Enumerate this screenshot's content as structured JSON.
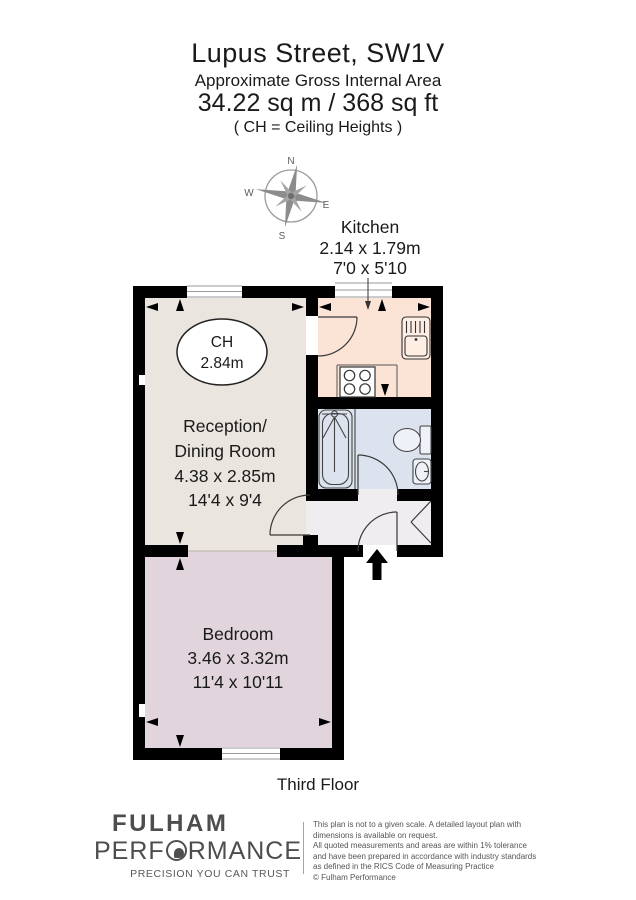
{
  "header": {
    "title": "Lupus Street, SW1V",
    "subtitle": "Approximate Gross Internal Area",
    "area": "34.22 sq m / 368 sq ft",
    "ch_note": "( CH = Ceiling Heights )"
  },
  "compass": {
    "n": "N",
    "e": "E",
    "s": "S",
    "w": "W"
  },
  "rooms": {
    "kitchen": {
      "name": "Kitchen",
      "dims_m": "2.14 x 1.79m",
      "dims_ft": "7'0 x 5'10"
    },
    "reception": {
      "name_line1": "Reception/",
      "name_line2": "Dining Room",
      "dims_m": "4.38 x 2.85m",
      "dims_ft": "14'4 x 9'4"
    },
    "bedroom": {
      "name": "Bedroom",
      "dims_m": "3.46 x 3.32m",
      "dims_ft": "11'4 x 10'11"
    },
    "ceiling_height": {
      "label": "CH",
      "value": "2.84m"
    }
  },
  "floor_label": "Third Floor",
  "footer": {
    "brand_line1": "FULHAM",
    "brand_line2_pre": "PERF",
    "brand_line2_post": "RMANCE",
    "tagline": "PRECISION YOU CAN TRUST",
    "disclaimer": [
      "This plan is not to a given scale. A detailed layout plan with",
      "dimensions is available on request.",
      "All quoted measurements and areas are within 1% tolerance",
      "and have been prepared in accordance with industry standards",
      "as defined in the RICS Code of Measuring Practice",
      "© Fulham Performance"
    ]
  },
  "colors": {
    "wall": "#000000",
    "reception": "#EAE5DE",
    "kitchen": "#FBE3D5",
    "bathroom": "#DCE3EE",
    "bedroom": "#E1D4DD",
    "hallway": "#EFEDEF",
    "fixture_fill": "#EEF1F8"
  }
}
